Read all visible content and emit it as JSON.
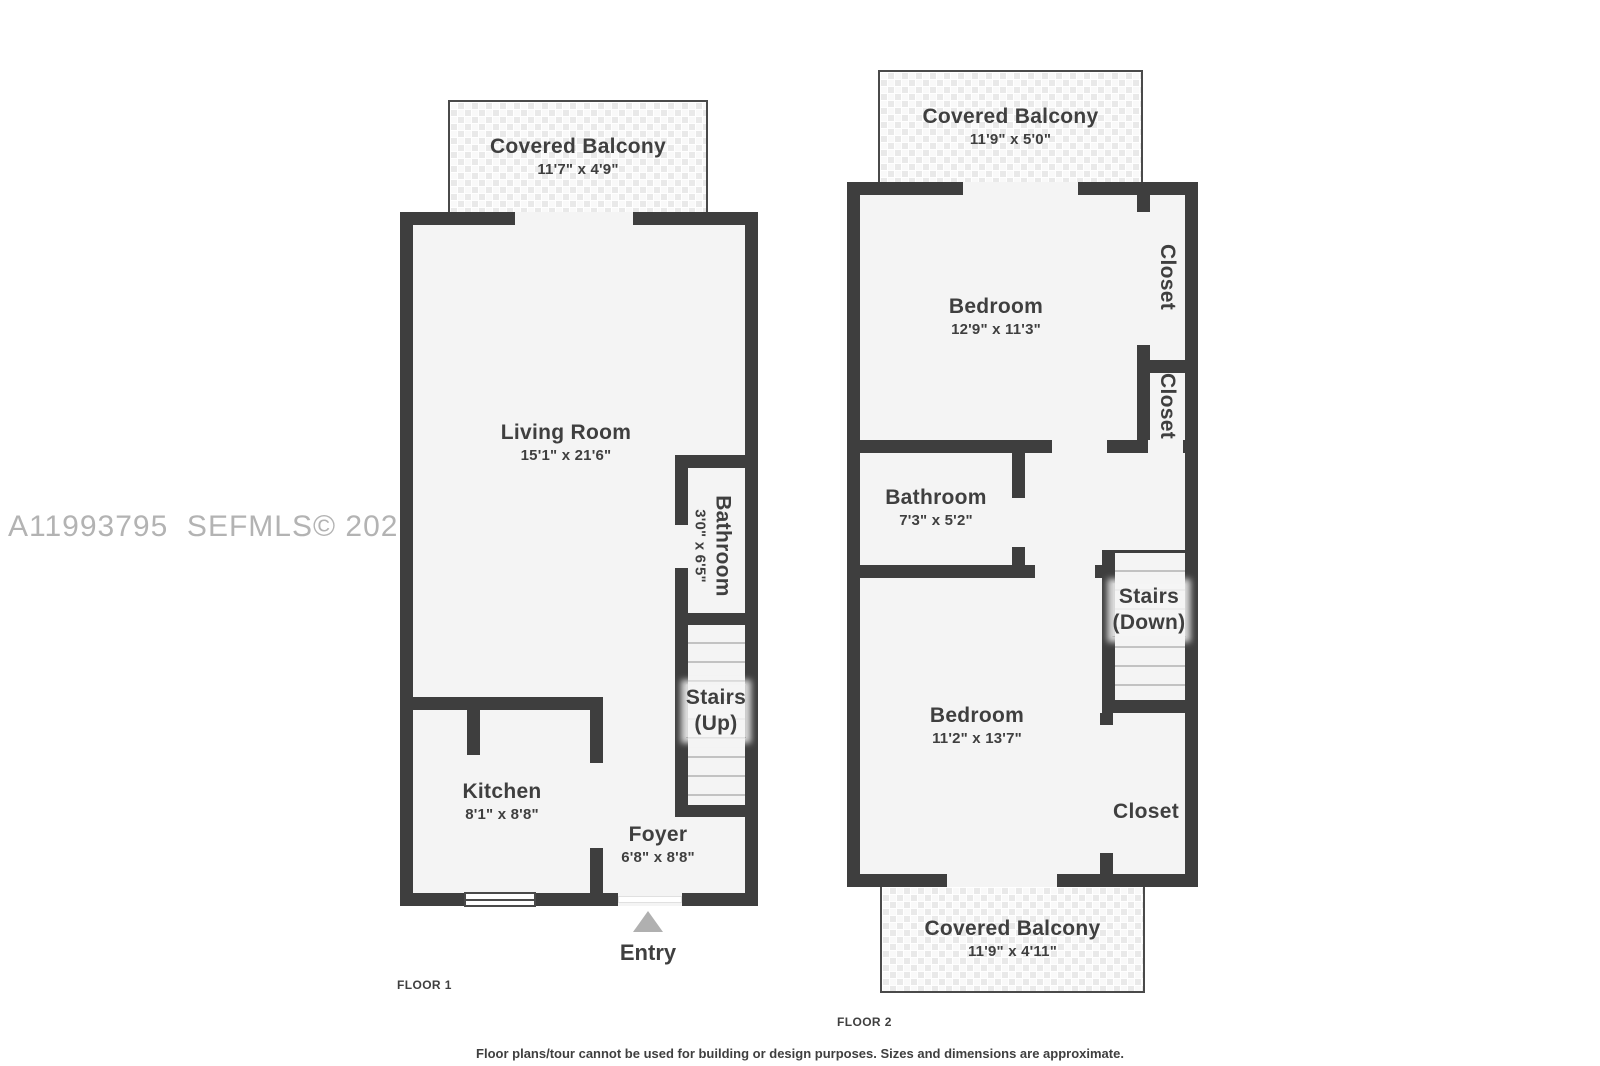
{
  "watermark": "A11993795  SEFMLS© 2026",
  "footer": "Floor plans/tour cannot be used for building or design purposes. Sizes and dimensions are approximate.",
  "floor1": {
    "label": "FLOOR 1",
    "balcony": {
      "name": "Covered Balcony",
      "dims": "11'7\" x 4'9\""
    },
    "living_room": {
      "name": "Living Room",
      "dims": "15'1\" x 21'6\""
    },
    "bathroom": {
      "name": "Bathroom",
      "dims": "3'0\" x 6'5\""
    },
    "stairs": {
      "name": "Stairs",
      "direction": "(Up)"
    },
    "kitchen": {
      "name": "Kitchen",
      "dims": "8'1\" x 8'8\""
    },
    "foyer": {
      "name": "Foyer",
      "dims": "6'8\" x 8'8\""
    },
    "entry_label": "Entry"
  },
  "floor2": {
    "label": "FLOOR 2",
    "balcony_top": {
      "name": "Covered Balcony",
      "dims": "11'9\" x 5'0\""
    },
    "bedroom_top": {
      "name": "Bedroom",
      "dims": "12'9\" x 11'3\""
    },
    "closet_top": {
      "name": "Closet"
    },
    "closet_middle": {
      "name": "Closet"
    },
    "bathroom": {
      "name": "Bathroom",
      "dims": "7'3\" x 5'2\""
    },
    "stairs": {
      "name": "Stairs",
      "direction": "(Down)"
    },
    "bedroom_bottom": {
      "name": "Bedroom",
      "dims": "11'2\" x 13'7\""
    },
    "closet_bottom": {
      "name": "Closet"
    },
    "balcony_bottom": {
      "name": "Covered Balcony",
      "dims": "11'9\" x 4'11\""
    }
  }
}
